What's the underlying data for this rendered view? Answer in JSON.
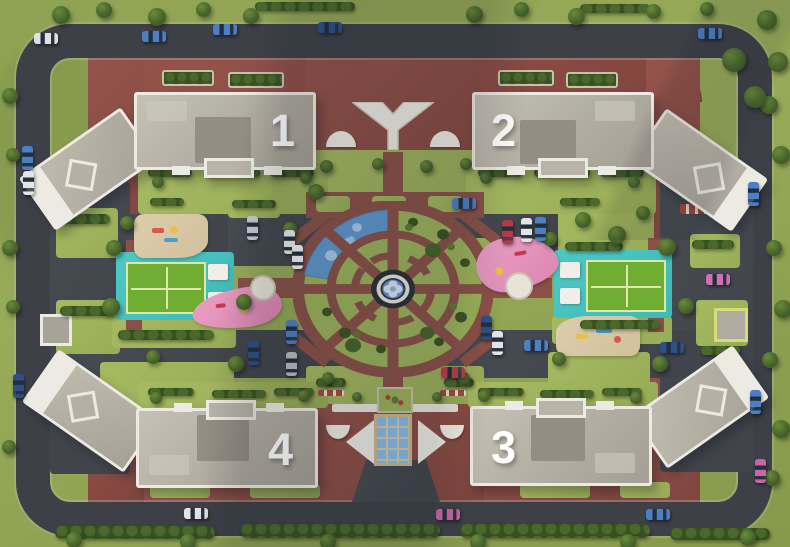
{
  "site": {
    "name": "Residential complex aerial site plan",
    "buildings": [
      {
        "id": "building-1",
        "label": "1"
      },
      {
        "id": "building-2",
        "label": "2"
      },
      {
        "id": "building-3",
        "label": "3"
      },
      {
        "id": "building-4",
        "label": "4"
      }
    ],
    "amenities": [
      "central-fountain",
      "circular-garden",
      "sport-court-west",
      "sport-court-east",
      "playground-sand-west",
      "playground-sand-east",
      "playground-pink-west",
      "playground-pink-east",
      "playground-blue",
      "entrance-pavilion-north",
      "entrance-pavilion-south",
      "perimeter-road",
      "parking-areas"
    ]
  },
  "palette": {
    "grass": "#97ab58",
    "lawn": "#a5ba61",
    "asphalt": "#41454b",
    "brick_plaza": "#8a4c44",
    "garden_path": "#8a5048",
    "roof": "#b2ada1",
    "parapet": "#eceae2",
    "hedge": "#36501f",
    "tree": "#44622a",
    "court_deck": "#46c2be",
    "court_green": "#6fae33",
    "sand": "#d8c7a4",
    "pink_zone": "#e394bc",
    "blue_zone": "#5e97ce",
    "water": "#6a93d8",
    "number_color": "#ffffff"
  },
  "asphalt": [
    [
      50,
      182,
      80,
      292
    ],
    [
      660,
      182,
      94,
      290
    ],
    [
      226,
      202,
      116,
      64
    ],
    [
      448,
      194,
      118,
      62
    ],
    [
      60,
      330,
      282,
      48
    ],
    [
      448,
      330,
      300,
      48
    ],
    [
      128,
      214,
      100,
      44
    ]
  ],
  "lawns": [
    [
      56,
      208,
      62,
      50
    ],
    [
      56,
      300,
      64,
      54
    ],
    [
      690,
      234,
      50,
      34
    ],
    [
      696,
      300,
      52,
      46
    ],
    [
      228,
      202,
      52,
      16
    ],
    [
      310,
      238,
      26,
      24
    ],
    [
      558,
      196,
      96,
      62
    ],
    [
      452,
      238,
      42,
      16
    ],
    [
      100,
      362,
      134,
      44
    ],
    [
      548,
      352,
      102,
      42
    ],
    [
      112,
      318,
      124,
      30
    ],
    [
      552,
      316,
      120,
      28
    ],
    [
      306,
      366,
      178,
      38
    ],
    [
      306,
      150,
      178,
      44
    ],
    [
      138,
      164,
      190,
      50
    ],
    [
      466,
      164,
      190,
      50
    ],
    [
      138,
      382,
      190,
      26
    ],
    [
      468,
      382,
      190,
      26
    ],
    [
      150,
      482,
      60,
      16
    ],
    [
      250,
      484,
      70,
      14
    ],
    [
      520,
      484,
      70,
      14
    ],
    [
      620,
      482,
      50,
      16
    ]
  ],
  "hedges": [
    [
      255,
      2,
      100,
      9
    ],
    [
      580,
      4,
      70,
      9
    ],
    [
      55,
      526,
      160,
      13
    ],
    [
      240,
      524,
      200,
      14
    ],
    [
      460,
      524,
      190,
      14
    ],
    [
      670,
      528,
      100,
      12
    ],
    [
      148,
      168,
      44,
      9
    ],
    [
      204,
      168,
      56,
      9
    ],
    [
      270,
      168,
      44,
      9
    ],
    [
      150,
      198,
      34,
      8
    ],
    [
      232,
      200,
      44,
      8
    ],
    [
      478,
      168,
      44,
      9
    ],
    [
      534,
      168,
      56,
      9
    ],
    [
      600,
      168,
      44,
      9
    ],
    [
      560,
      198,
      40,
      8
    ],
    [
      148,
      388,
      46,
      8
    ],
    [
      212,
      390,
      54,
      8
    ],
    [
      274,
      388,
      40,
      8
    ],
    [
      478,
      388,
      46,
      8
    ],
    [
      540,
      390,
      54,
      8
    ],
    [
      602,
      388,
      40,
      8
    ],
    [
      118,
      330,
      96,
      10
    ],
    [
      580,
      320,
      80,
      9
    ],
    [
      60,
      214,
      50,
      10
    ],
    [
      60,
      306,
      54,
      10
    ],
    [
      692,
      240,
      42,
      9
    ],
    [
      700,
      346,
      40,
      9
    ],
    [
      565,
      242,
      58,
      9
    ],
    [
      316,
      378,
      30,
      9
    ],
    [
      444,
      378,
      30,
      9
    ]
  ],
  "hedgeboxes": [
    [
      162,
      70,
      48,
      12
    ],
    [
      228,
      72,
      52,
      12
    ],
    [
      498,
      70,
      52,
      12
    ],
    [
      566,
      72,
      48,
      12
    ]
  ],
  "trees": [
    [
      52,
      6,
      18
    ],
    [
      96,
      2,
      16
    ],
    [
      148,
      8,
      18
    ],
    [
      196,
      2,
      15
    ],
    [
      243,
      8,
      16
    ],
    [
      466,
      6,
      17
    ],
    [
      514,
      2,
      15
    ],
    [
      568,
      8,
      17
    ],
    [
      646,
      4,
      15
    ],
    [
      700,
      2,
      14
    ],
    [
      757,
      10,
      20
    ],
    [
      768,
      52,
      20
    ],
    [
      760,
      96,
      18
    ],
    [
      772,
      146,
      18
    ],
    [
      766,
      240,
      16
    ],
    [
      774,
      300,
      18
    ],
    [
      762,
      352,
      16
    ],
    [
      772,
      420,
      18
    ],
    [
      764,
      470,
      16
    ],
    [
      2,
      88,
      16
    ],
    [
      6,
      148,
      14
    ],
    [
      2,
      240,
      16
    ],
    [
      6,
      300,
      14
    ],
    [
      2,
      440,
      14
    ],
    [
      66,
      532,
      16
    ],
    [
      180,
      534,
      16
    ],
    [
      320,
      534,
      16
    ],
    [
      470,
      534,
      16
    ],
    [
      620,
      534,
      16
    ],
    [
      740,
      530,
      16
    ],
    [
      120,
      216,
      14
    ],
    [
      106,
      240,
      16
    ],
    [
      102,
      298,
      18
    ],
    [
      236,
      294,
      16
    ],
    [
      146,
      350,
      14
    ],
    [
      228,
      356,
      16
    ],
    [
      308,
      184,
      16
    ],
    [
      283,
      222,
      14
    ],
    [
      543,
      232,
      14
    ],
    [
      658,
      238,
      18
    ],
    [
      678,
      298,
      16
    ],
    [
      552,
      352,
      14
    ],
    [
      652,
      356,
      16
    ],
    [
      575,
      212,
      16
    ],
    [
      608,
      226,
      18
    ],
    [
      636,
      206,
      14
    ],
    [
      152,
      176,
      12
    ],
    [
      300,
      172,
      12
    ],
    [
      480,
      172,
      12
    ],
    [
      628,
      176,
      12
    ],
    [
      150,
      392,
      12
    ],
    [
      298,
      390,
      12
    ],
    [
      478,
      390,
      12
    ],
    [
      630,
      392,
      12
    ],
    [
      722,
      48,
      24
    ],
    [
      744,
      86,
      22
    ],
    [
      322,
      372,
      12
    ],
    [
      458,
      372,
      12
    ],
    [
      320,
      160,
      13
    ],
    [
      372,
      158,
      12
    ],
    [
      420,
      160,
      13
    ],
    [
      460,
      158,
      12
    ],
    [
      352,
      392,
      10
    ],
    [
      432,
      392,
      10
    ]
  ],
  "cars": [
    {
      "x": 34,
      "y": 33,
      "o": "h",
      "c": "#dde1e5"
    },
    {
      "x": 142,
      "y": 31,
      "o": "h",
      "c": "#4d7fc4"
    },
    {
      "x": 213,
      "y": 24,
      "o": "h",
      "c": "#4d7fc4"
    },
    {
      "x": 318,
      "y": 22,
      "o": "h",
      "c": "#2d4f8a"
    },
    {
      "x": 698,
      "y": 28,
      "o": "h",
      "c": "#4d7fc4"
    },
    {
      "x": 22,
      "y": 146,
      "o": "v",
      "c": "#4d7fc4"
    },
    {
      "x": 23,
      "y": 171,
      "o": "v",
      "c": "#e2e4e6"
    },
    {
      "x": 13,
      "y": 374,
      "o": "v",
      "c": "#2d4f8a"
    },
    {
      "x": 184,
      "y": 508,
      "o": "h",
      "c": "#e2e4e6"
    },
    {
      "x": 436,
      "y": 509,
      "o": "h",
      "c": "#c864a8"
    },
    {
      "x": 646,
      "y": 509,
      "o": "h",
      "c": "#4d7fc4"
    },
    {
      "x": 755,
      "y": 459,
      "o": "v",
      "c": "#c864a8"
    },
    {
      "x": 750,
      "y": 390,
      "o": "v",
      "c": "#4d7fc4"
    },
    {
      "x": 247,
      "y": 216,
      "o": "v",
      "c": "#c6cacf"
    },
    {
      "x": 284,
      "y": 230,
      "o": "v",
      "c": "#e8eaec"
    },
    {
      "x": 292,
      "y": 245,
      "o": "v",
      "c": "#f0f1f2"
    },
    {
      "x": 452,
      "y": 198,
      "o": "h",
      "c": "#4d7fc4"
    },
    {
      "x": 502,
      "y": 220,
      "o": "v",
      "c": "#b43a44"
    },
    {
      "x": 521,
      "y": 218,
      "o": "v",
      "c": "#e2e4e6"
    },
    {
      "x": 535,
      "y": 217,
      "o": "v",
      "c": "#4d7fc4"
    },
    {
      "x": 286,
      "y": 320,
      "o": "v",
      "c": "#4d7fc4"
    },
    {
      "x": 248,
      "y": 341,
      "o": "v",
      "c": "#2d4f8a"
    },
    {
      "x": 286,
      "y": 352,
      "o": "v",
      "c": "#b8bcc2"
    },
    {
      "x": 481,
      "y": 316,
      "o": "v",
      "c": "#2d4f8a"
    },
    {
      "x": 492,
      "y": 331,
      "o": "v",
      "c": "#e2e4e6"
    },
    {
      "x": 441,
      "y": 367,
      "o": "h",
      "c": "#c23a4e"
    },
    {
      "x": 524,
      "y": 340,
      "o": "h",
      "c": "#4d7fc4"
    },
    {
      "x": 660,
      "y": 342,
      "o": "h",
      "c": "#2d4f8a"
    },
    {
      "x": 706,
      "y": 274,
      "o": "h",
      "c": "#d070b0"
    },
    {
      "x": 748,
      "y": 182,
      "o": "v",
      "c": "#4d7fc4"
    }
  ]
}
